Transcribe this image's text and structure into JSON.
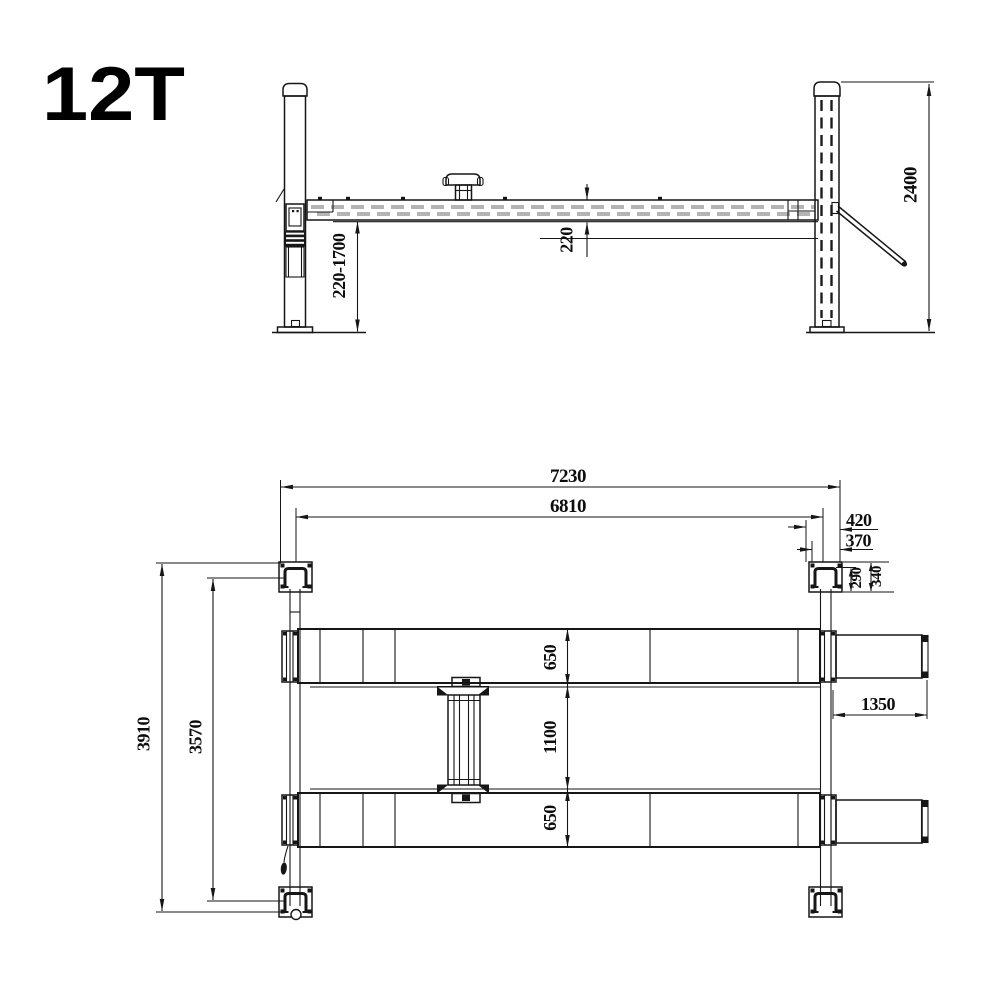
{
  "title": "12T",
  "drawing": {
    "line_color": "#161616",
    "side_view": {
      "label": "side-elevation",
      "dims": {
        "lift_height_range": "220-1700",
        "runway_thickness": "220",
        "column_height": "2400"
      }
    },
    "plan_view": {
      "label": "top-plan",
      "dims": {
        "overall_length": "7230",
        "inner_length": "6810",
        "post_width": "420",
        "post_inner_width": "370",
        "channel_depth": "290",
        "post_depth": "340",
        "runway_width_front": "650",
        "runway_gap": "1100",
        "runway_width_rear": "650",
        "ramp_length": "1350",
        "overall_width": "3910",
        "inner_width": "3570"
      }
    }
  }
}
